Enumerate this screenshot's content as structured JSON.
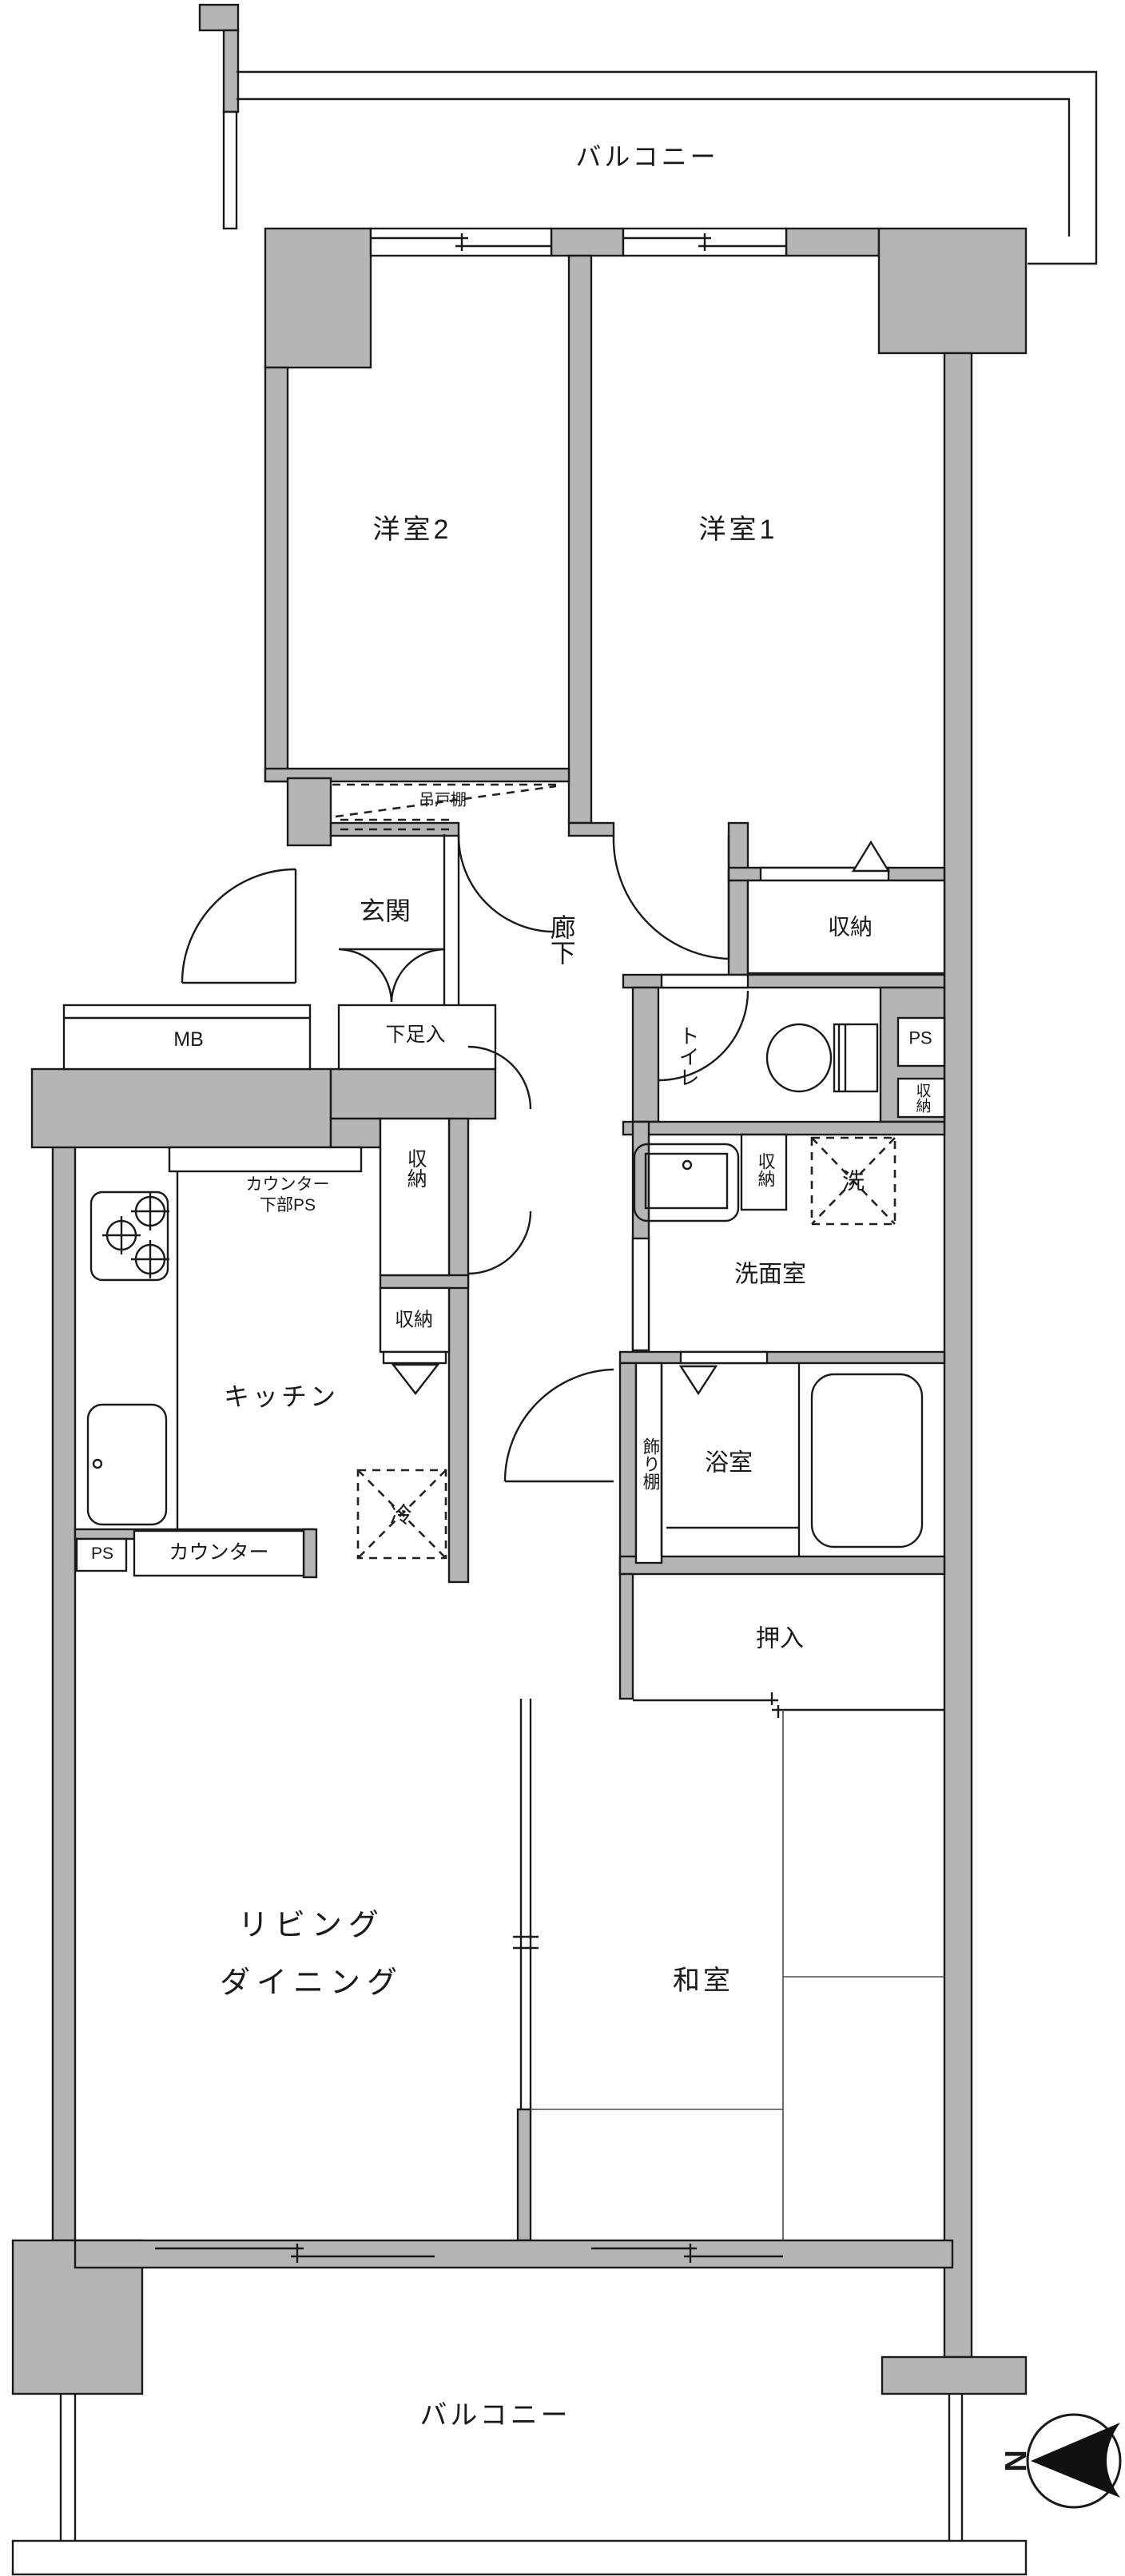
{
  "colors": {
    "wall_gray": "#b5b5b5",
    "line": "#1a1a1a"
  },
  "labels": {
    "balcony_top": "バルコニー",
    "bedroom2": "洋室2",
    "bedroom1": "洋室1",
    "hanging_cupboard": "吊戸棚",
    "entrance": "玄関",
    "hallway": "廊下",
    "shoe_cabinet": "下足入",
    "closet_bedroom1": "収納",
    "ps_upper": "PS",
    "closet_small": "収納",
    "toilet": "トイレ",
    "meter_box": "MB",
    "counter_lower_ps_line1": "カウンター",
    "counter_lower_ps_line2": "下部PS",
    "closet_tall": "収納",
    "closet_kitchen": "収納",
    "closet_washroom": "収納",
    "washing_machine": "洗",
    "washroom": "洗面室",
    "kitchen": "キッチン",
    "bathroom": "浴室",
    "display_shelf": "飾り棚",
    "refrigerator": "冷",
    "counter": "カウンター",
    "ps_kitchen": "PS",
    "oshiire": "押入",
    "living_line1": "リビング",
    "living_line2": "ダイニング",
    "japanese_room": "和室",
    "balcony_bottom": "バルコニー",
    "compass_north": "N"
  }
}
